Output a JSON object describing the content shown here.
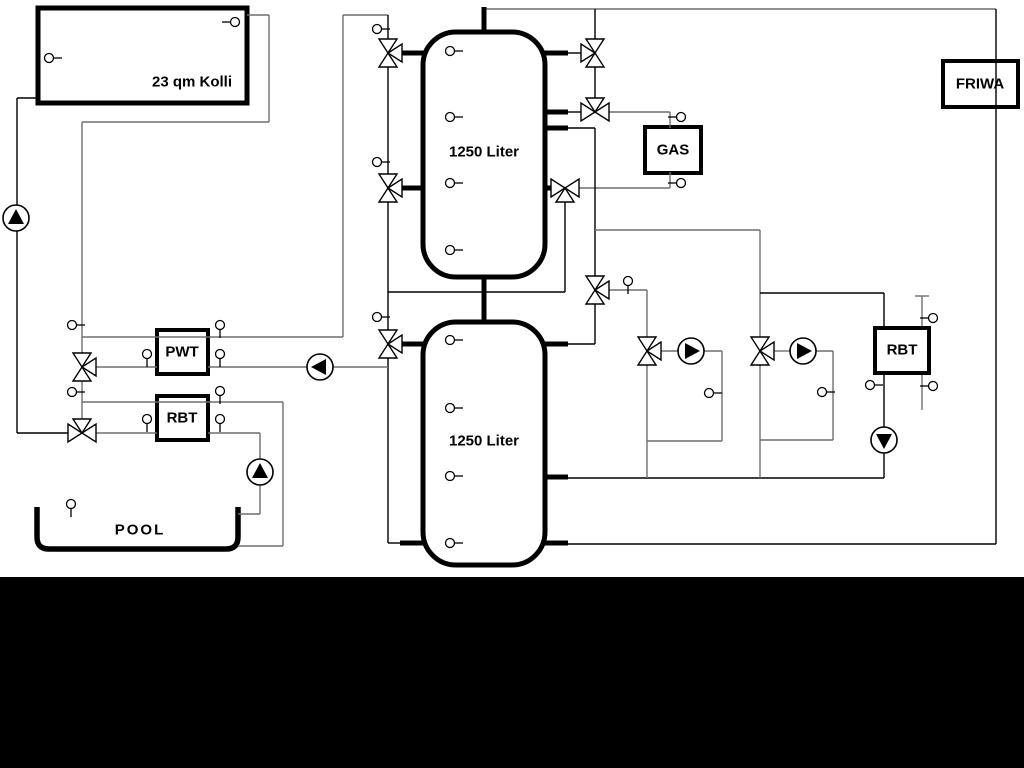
{
  "labels": {
    "collector": "23 qm Kolli",
    "tank1": "1250 Liter",
    "tank2": "1250 Liter",
    "pwt": "PWT",
    "rbt_left": "RBT",
    "gas": "GAS",
    "rbt_right": "RBT",
    "friwa": "FRIWA",
    "pool": "POOL"
  },
  "colors": {
    "black": "#000000",
    "gray": "#6e6e6e",
    "background": "#ffffff",
    "bottom_bar": "#000000"
  },
  "diagram": {
    "under_lines": [
      [
        922,
        296,
        922,
        410,
        "g"
      ],
      [
        915,
        296,
        929,
        296,
        "g"
      ]
    ],
    "tanks": [
      {
        "name": "buffer-tank-1",
        "x": 423,
        "y": 32,
        "w": 122,
        "h": 245,
        "r": 33
      },
      {
        "name": "buffer-tank-2",
        "x": 423,
        "y": 322,
        "w": 122,
        "h": 243,
        "r": 33
      }
    ],
    "boxes": [
      {
        "name": "solar-collector-box",
        "x": 38,
        "y": 8,
        "w": 209,
        "h": 95,
        "sw": 5
      },
      {
        "name": "pwt-heat-exchanger-box",
        "x": 157,
        "y": 330,
        "w": 51,
        "h": 44,
        "sw": 4
      },
      {
        "name": "rbt-left-box",
        "x": 157,
        "y": 396,
        "w": 51,
        "h": 44,
        "sw": 4
      },
      {
        "name": "gas-boiler-box",
        "x": 645,
        "y": 127,
        "w": 56,
        "h": 46,
        "sw": 4
      },
      {
        "name": "rbt-right-box",
        "x": 875,
        "y": 328,
        "w": 54,
        "h": 45,
        "sw": 4
      },
      {
        "name": "friwa-box",
        "x": 943,
        "y": 61,
        "w": 75,
        "h": 46,
        "sw": 4
      }
    ],
    "pool": {
      "x": 37,
      "y": 507,
      "w": 201,
      "h": 42,
      "r": 12,
      "sw": 5.5
    },
    "lines": [
      [
        17,
        98,
        17,
        433,
        "b"
      ],
      [
        17,
        98,
        38,
        98,
        "b"
      ],
      [
        17,
        433,
        68,
        433,
        "b"
      ],
      [
        247,
        15,
        269,
        15,
        "g"
      ],
      [
        269,
        15,
        269,
        122,
        "g"
      ],
      [
        82,
        122,
        269,
        122,
        "g"
      ],
      [
        82,
        122,
        82,
        354,
        "g"
      ],
      [
        82,
        380,
        82,
        420,
        "g"
      ],
      [
        82,
        337,
        343,
        337,
        "g"
      ],
      [
        343,
        15,
        343,
        337,
        "g"
      ],
      [
        343,
        15,
        388,
        15,
        "g"
      ],
      [
        388,
        15,
        388,
        543,
        "b"
      ],
      [
        388,
        543,
        400,
        543,
        "b"
      ],
      [
        96,
        367,
        157,
        367,
        "g"
      ],
      [
        208,
        367,
        388,
        367,
        "g"
      ],
      [
        96,
        433,
        157,
        433,
        "g"
      ],
      [
        208,
        433,
        260,
        433,
        "g"
      ],
      [
        260,
        433,
        260,
        514,
        "g"
      ],
      [
        238,
        514,
        260,
        514,
        "g"
      ],
      [
        82,
        402,
        283,
        402,
        "g"
      ],
      [
        283,
        402,
        283,
        546,
        "g"
      ],
      [
        238,
        546,
        283,
        546,
        "g"
      ],
      [
        484,
        9,
        996,
        9,
        "g"
      ],
      [
        996,
        9,
        996,
        544,
        "b"
      ],
      [
        566,
        544,
        996,
        544,
        "b"
      ],
      [
        595,
        9,
        595,
        39,
        "b"
      ],
      [
        595,
        67,
        595,
        98,
        "b"
      ],
      [
        566,
        53,
        581,
        53,
        "b"
      ],
      [
        566,
        112,
        581,
        112,
        "b"
      ],
      [
        609,
        112,
        670,
        112,
        "g"
      ],
      [
        670,
        112,
        670,
        128,
        "g"
      ],
      [
        579,
        188,
        670,
        188,
        "g"
      ],
      [
        670,
        172,
        670,
        188,
        "g"
      ],
      [
        565,
        202,
        565,
        292,
        "b"
      ],
      [
        388,
        292,
        565,
        292,
        "b"
      ],
      [
        566,
        128,
        595,
        128,
        "b"
      ],
      [
        595,
        128,
        595,
        276,
        "b"
      ],
      [
        595,
        304,
        595,
        344,
        "b"
      ],
      [
        566,
        344,
        595,
        344,
        "b"
      ],
      [
        595,
        230,
        760,
        230,
        "g"
      ],
      [
        760,
        230,
        760,
        337,
        "g"
      ],
      [
        760,
        293,
        884,
        293,
        "b"
      ],
      [
        884,
        293,
        884,
        328,
        "b"
      ],
      [
        884,
        373,
        884,
        427,
        "b"
      ],
      [
        884,
        453,
        884,
        478,
        "b"
      ],
      [
        566,
        478,
        884,
        478,
        "b"
      ],
      [
        609,
        290,
        647,
        290,
        "g"
      ],
      [
        647,
        290,
        647,
        337,
        "g"
      ],
      [
        647,
        365,
        647,
        478,
        "g"
      ],
      [
        661,
        351,
        678,
        351,
        "g"
      ],
      [
        704,
        351,
        722,
        351,
        "g"
      ],
      [
        722,
        351,
        722,
        441,
        "g"
      ],
      [
        647,
        441,
        722,
        441,
        "g"
      ],
      [
        760,
        365,
        760,
        478,
        "g"
      ],
      [
        774,
        351,
        790,
        351,
        "g"
      ],
      [
        816,
        351,
        833,
        351,
        "g"
      ],
      [
        833,
        351,
        833,
        440,
        "g"
      ],
      [
        760,
        440,
        833,
        440,
        "g"
      ]
    ],
    "stubs": [
      [
        484,
        7,
        484,
        34
      ],
      [
        484,
        275,
        484,
        324
      ],
      [
        400,
        53,
        425,
        53
      ],
      [
        400,
        188,
        425,
        188
      ],
      [
        400,
        344,
        425,
        344
      ],
      [
        400,
        543,
        425,
        543
      ],
      [
        543,
        53,
        568,
        53
      ],
      [
        543,
        112,
        568,
        112
      ],
      [
        543,
        128,
        568,
        128
      ],
      [
        543,
        188,
        552,
        188
      ],
      [
        543,
        344,
        568,
        344
      ],
      [
        543,
        477,
        568,
        477
      ],
      [
        543,
        543,
        568,
        543
      ]
    ],
    "valves": [
      {
        "x": 82,
        "y": 367,
        "t": "vr"
      },
      {
        "x": 82,
        "y": 433,
        "t": "ht"
      },
      {
        "x": 388,
        "y": 53,
        "t": "vr"
      },
      {
        "x": 388,
        "y": 188,
        "t": "vr"
      },
      {
        "x": 388,
        "y": 344,
        "t": "vr"
      },
      {
        "x": 595,
        "y": 53,
        "t": "vl"
      },
      {
        "x": 595,
        "y": 112,
        "t": "ht"
      },
      {
        "x": 565,
        "y": 188,
        "t": "hb"
      },
      {
        "x": 595,
        "y": 290,
        "t": "vr"
      },
      {
        "x": 647,
        "y": 351,
        "t": "vr"
      },
      {
        "x": 760,
        "y": 351,
        "t": "vr"
      }
    ],
    "pumps": [
      {
        "x": 16,
        "y": 218,
        "d": "u"
      },
      {
        "x": 320,
        "y": 367,
        "d": "l"
      },
      {
        "x": 260,
        "y": 472,
        "d": "u"
      },
      {
        "x": 691,
        "y": 351,
        "d": "r"
      },
      {
        "x": 803,
        "y": 351,
        "d": "r"
      },
      {
        "x": 884,
        "y": 440,
        "d": "d"
      }
    ],
    "sensors": [
      {
        "x": 49,
        "y": 58,
        "s": "r"
      },
      {
        "x": 235,
        "y": 22,
        "s": "l"
      },
      {
        "x": 450,
        "y": 51,
        "s": "r"
      },
      {
        "x": 450,
        "y": 117,
        "s": "r"
      },
      {
        "x": 450,
        "y": 183,
        "s": "r"
      },
      {
        "x": 450,
        "y": 250,
        "s": "r"
      },
      {
        "x": 450,
        "y": 340,
        "s": "r"
      },
      {
        "x": 450,
        "y": 408,
        "s": "r"
      },
      {
        "x": 450,
        "y": 476,
        "s": "r"
      },
      {
        "x": 450,
        "y": 543,
        "s": "r"
      },
      {
        "x": 377,
        "y": 29,
        "s": "r"
      },
      {
        "x": 377,
        "y": 162,
        "s": "r"
      },
      {
        "x": 377,
        "y": 317,
        "s": "r"
      },
      {
        "x": 72,
        "y": 325,
        "s": "r"
      },
      {
        "x": 72,
        "y": 392,
        "s": "r"
      },
      {
        "x": 147,
        "y": 354,
        "s": "d"
      },
      {
        "x": 220,
        "y": 325,
        "s": "d"
      },
      {
        "x": 220,
        "y": 354,
        "s": "d"
      },
      {
        "x": 147,
        "y": 419,
        "s": "d"
      },
      {
        "x": 220,
        "y": 391,
        "s": "d"
      },
      {
        "x": 220,
        "y": 419,
        "s": "d"
      },
      {
        "x": 71,
        "y": 504,
        "s": "d"
      },
      {
        "x": 628,
        "y": 281,
        "s": "d"
      },
      {
        "x": 681,
        "y": 117,
        "s": "l"
      },
      {
        "x": 681,
        "y": 183,
        "s": "l"
      },
      {
        "x": 709,
        "y": 393,
        "s": "r"
      },
      {
        "x": 822,
        "y": 392,
        "s": "r"
      },
      {
        "x": 870,
        "y": 385,
        "s": "r"
      },
      {
        "x": 933,
        "y": 318,
        "s": "l"
      },
      {
        "x": 933,
        "y": 386,
        "s": "l"
      }
    ]
  }
}
